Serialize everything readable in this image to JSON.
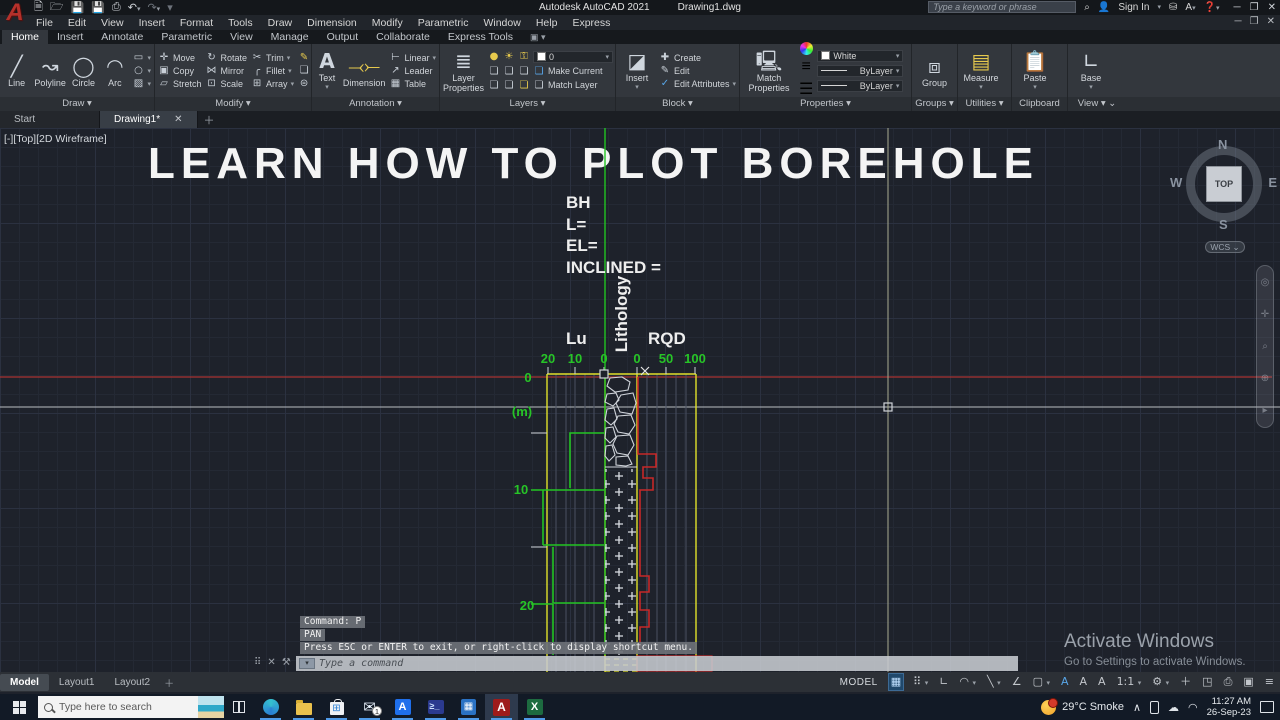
{
  "titlebar": {
    "app_title": "Autodesk AutoCAD 2021",
    "doc_title": "Drawing1.dwg",
    "search_placeholder": "Type a keyword or phrase",
    "signin_label": "Sign In"
  },
  "menubar": {
    "items": [
      "File",
      "Edit",
      "View",
      "Insert",
      "Format",
      "Tools",
      "Draw",
      "Dimension",
      "Modify",
      "Parametric",
      "Window",
      "Help",
      "Express"
    ]
  },
  "ribbon_tabs": {
    "items": [
      "Home",
      "Insert",
      "Annotate",
      "Parametric",
      "View",
      "Manage",
      "Output",
      "Collaborate",
      "Express Tools"
    ],
    "active": "Home"
  },
  "ribbon": {
    "draw": {
      "label": "Draw",
      "line": "Line",
      "polyline": "Polyline",
      "circle": "Circle",
      "arc": "Arc"
    },
    "modify": {
      "label": "Modify",
      "move": "Move",
      "copy": "Copy",
      "stretch": "Stretch",
      "rotate": "Rotate",
      "mirror": "Mirror",
      "scale": "Scale",
      "trim": "Trim",
      "fillet": "Fillet",
      "array": "Array"
    },
    "annotation": {
      "label": "Annotation",
      "text": "Text",
      "dimension": "Dimension",
      "linear": "Linear",
      "leader": "Leader",
      "table": "Table"
    },
    "layers": {
      "label": "Layers",
      "layer_properties": "Layer Properties",
      "current_layer": "0",
      "make_current": "Make Current",
      "match_layer": "Match Layer"
    },
    "block": {
      "label": "Block",
      "insert": "Insert",
      "create": "Create",
      "edit": "Edit",
      "edit_attributes": "Edit Attributes"
    },
    "properties": {
      "label": "Properties",
      "match_properties": "Match Properties",
      "color": "White",
      "lineweight": "ByLayer",
      "linetype": "ByLayer"
    },
    "groups": {
      "label": "Groups",
      "group": "Group"
    },
    "utilities": {
      "label": "Utilities",
      "measure": "Measure"
    },
    "clipboard": {
      "label": "Clipboard",
      "paste": "Paste"
    },
    "view": {
      "label": "View",
      "base": "Base"
    }
  },
  "filetabs": {
    "start": "Start",
    "drawing": "Drawing1*"
  },
  "canvas": {
    "viewport_label": "[-][Top][2D Wireframe]",
    "banner": "LEARN HOW TO PLOT BOREHOLE",
    "bh": {
      "l1": "BH",
      "l2": "L=",
      "l3": "EL=",
      "l4": "INCLINED ="
    },
    "lu": "Lu",
    "lithology": "Lithology",
    "rqd": "RQD",
    "lu_ticks": [
      "20",
      "10",
      "0"
    ],
    "rqd_ticks": [
      "0",
      "50",
      "100"
    ],
    "depth": {
      "d0": "0",
      "unit": "(m)",
      "d10": "10",
      "d20": "20"
    },
    "viewcube": {
      "n": "N",
      "w": "W",
      "e": "E",
      "s": "S",
      "top": "TOP",
      "wcs": "WCS"
    },
    "activate": {
      "l1": "Activate Windows",
      "l2": "Go to Settings to activate Windows."
    },
    "colors": {
      "boundary_yellow": "#e0e02a",
      "lu_green": "#22c422",
      "rqd_red": "#c62828",
      "axis_green": "#27c427",
      "xline_red": "#a83232"
    }
  },
  "command": {
    "l1": "Command: P",
    "l2": "PAN",
    "l3": "Press ESC or ENTER to exit, or right-click to display shortcut menu.",
    "placeholder": "Type a command"
  },
  "statusbar": {
    "model": "Model",
    "layout1": "Layout1",
    "layout2": "Layout2",
    "mode": "MODEL",
    "scale": "1:1"
  },
  "taskbar": {
    "search_placeholder": "Type here to search",
    "weather": "29°C Smoke",
    "time": "11:27 AM",
    "date": "26-Sep-23",
    "mail_badge": "1"
  }
}
